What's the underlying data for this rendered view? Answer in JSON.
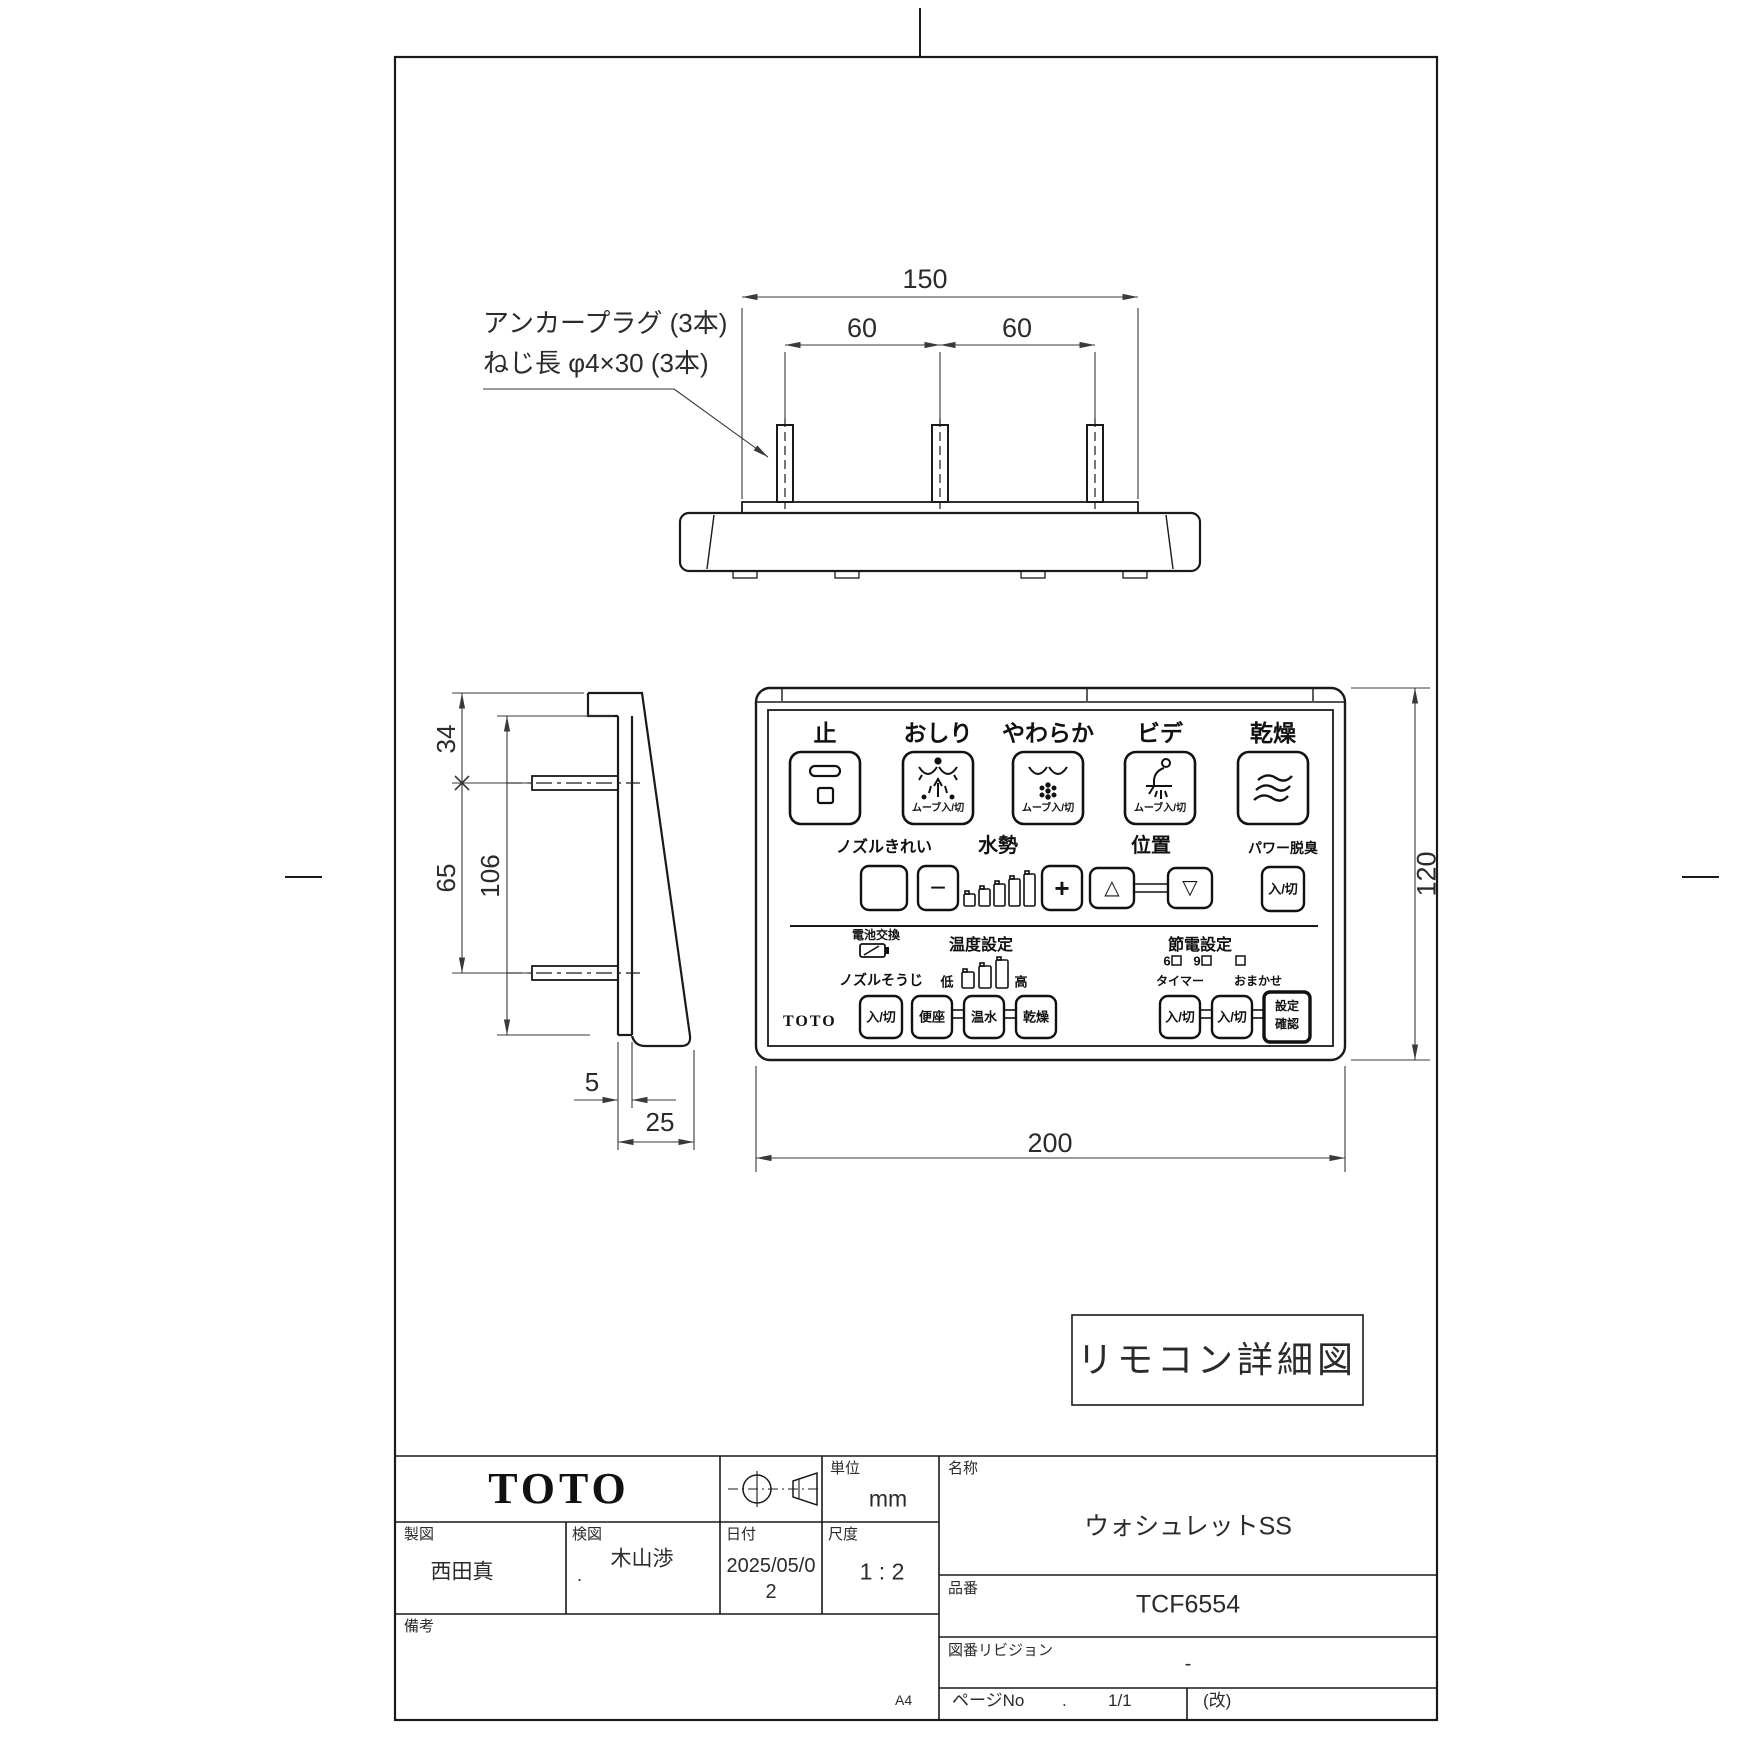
{
  "top_view": {
    "dim_overall": "150",
    "dim_pitch_left": "60",
    "dim_pitch_right": "60",
    "anchor_label_line1": "アンカープラグ (3本)",
    "anchor_label_line2": "ねじ長 φ4×30 (3本)"
  },
  "side_view": {
    "dim_top": "34",
    "dim_mid": "65",
    "dim_plate_height": "106",
    "dim_plate_thickness": "5",
    "dim_depth": "25"
  },
  "front_view": {
    "dim_width": "200",
    "dim_height": "120",
    "remote": {
      "row1": {
        "stop_label": "止",
        "oshiri_label": "おしり",
        "soft_label": "やわらか",
        "bidet_label": "ビデ",
        "dry_label": "乾燥",
        "move_toggle": "ムーブ入/切"
      },
      "row2": {
        "nozzle_clean_label": "ノズルきれい",
        "water_pressure_label": "水勢",
        "position_label": "位置",
        "deodorizer_label": "パワー脱臭",
        "minus": "−",
        "plus": "+",
        "up": "△",
        "down": "▽",
        "on_off": "入/切"
      },
      "row3": {
        "battery_label": "電池交換",
        "nozzle_wash_label": "ノズルそうじ",
        "temp_label": "温度設定",
        "low": "低",
        "high": "高",
        "seat": "便座",
        "warm_water": "温水",
        "dry": "乾燥",
        "eco_label": "節電設定",
        "six": "6",
        "nine": "9",
        "timer_label": "タイマー",
        "auto_label": "おまかせ",
        "on_off": "入/切",
        "confirm_line1": "設定",
        "confirm_line2": "確認",
        "brand": "TOTO"
      }
    }
  },
  "callout": {
    "title": "リモコン詳細図"
  },
  "title_block": {
    "brand": "TOTO",
    "unit_label": "単位",
    "unit_value": "mm",
    "drafter_label": "製図",
    "drafter_value": "西田真",
    "checker_label": "検図",
    "checker_dot": ".",
    "checker_value": "木山渉",
    "date_label": "日付",
    "date_value": "2025/05/02",
    "scale_label": "尺度",
    "scale_value": "1 : 2",
    "remarks_label": "備考",
    "name_label": "名称",
    "name_value": "ウォシュレットSS",
    "part_label": "品番",
    "part_value": "TCF6554",
    "revision_label": "図番リビジョン",
    "revision_value": "-",
    "page_label": "ページNo",
    "page_dot": ".",
    "page_value": "1/1",
    "rev_mark": "(改)",
    "paper": "A4"
  }
}
